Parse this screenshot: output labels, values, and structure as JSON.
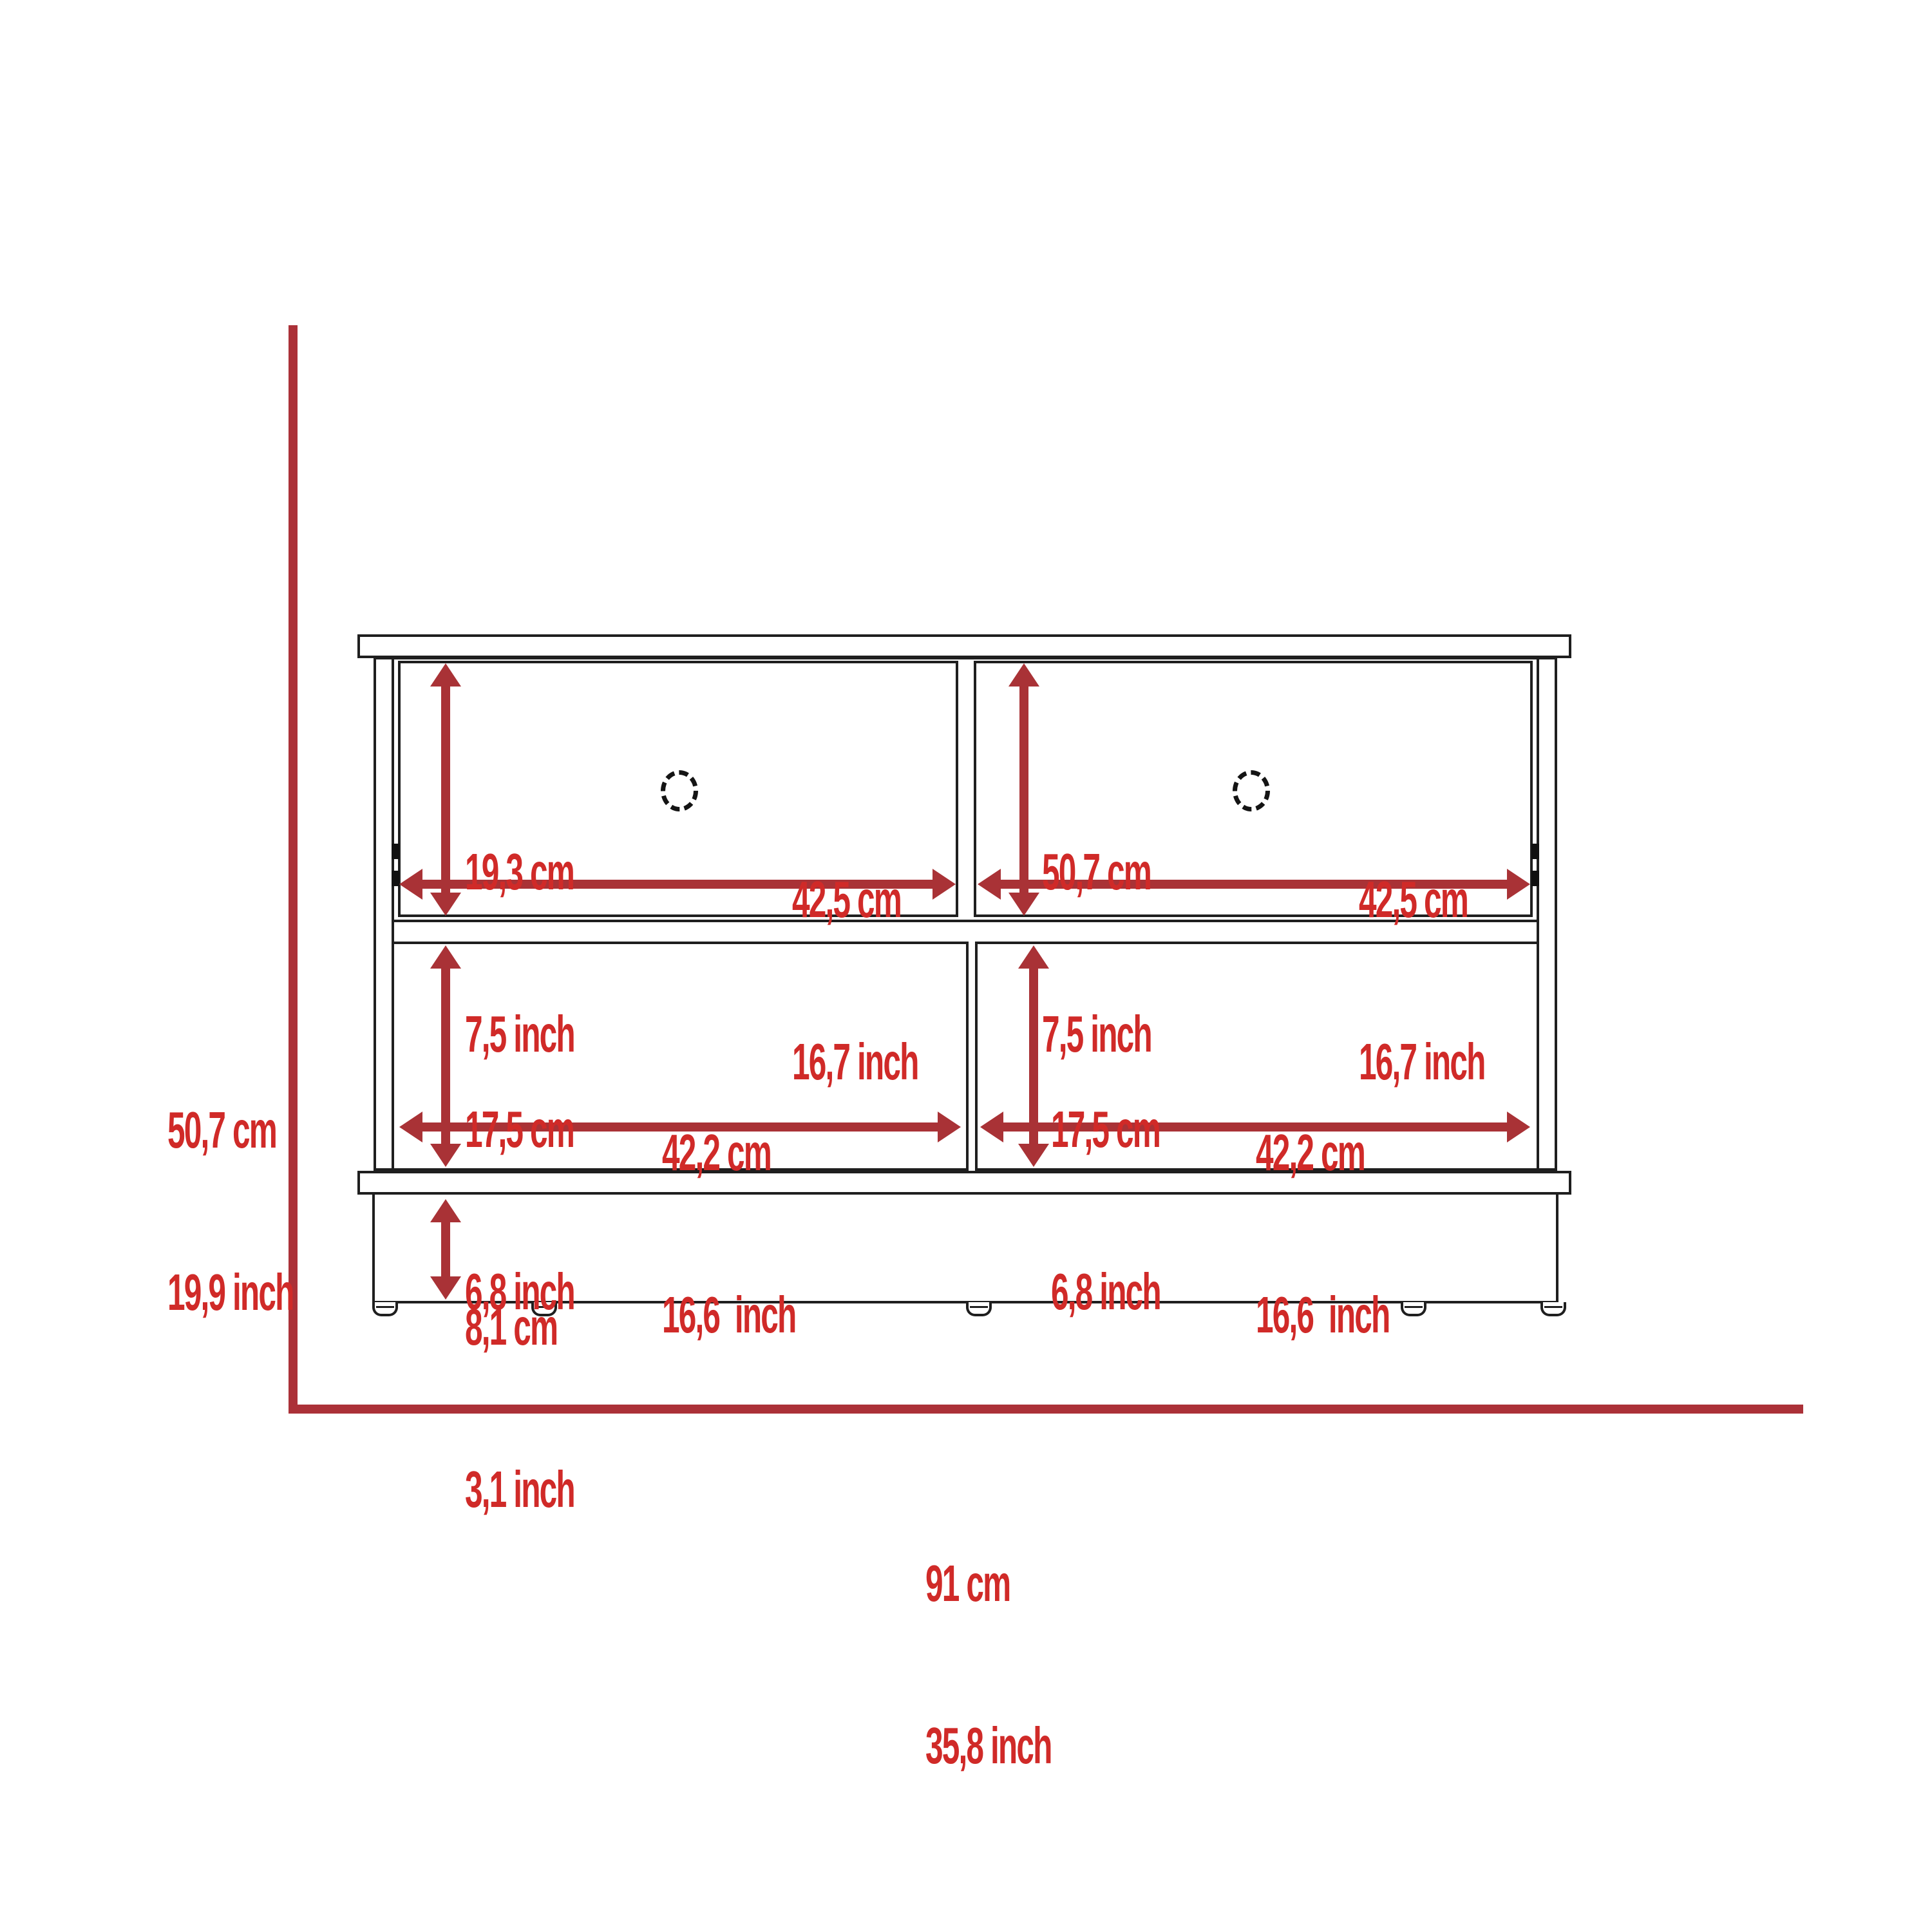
{
  "diagram": {
    "title": "storage-bench-dimension-drawing",
    "colors": {
      "background": "#ffffff",
      "outline": "#1f1f1f",
      "dimension_line": "#ab3138",
      "dimension_arrow": "#a93236",
      "label_text": "#d02a28"
    },
    "labels": {
      "overall_height": {
        "cm": "50,7 cm",
        "inch": "19,9 inch"
      },
      "overall_width": {
        "cm": "91 cm",
        "inch": "35,8 inch"
      },
      "top_left_drawer_height": {
        "cm": "19,3 cm",
        "inch": "7,5 inch"
      },
      "top_left_drawer_width": {
        "cm": "42,5 cm",
        "inch": "16,7 inch"
      },
      "top_right_drawer_height": {
        "cm": "50,7 cm",
        "inch": "7,5 inch"
      },
      "top_right_drawer_width": {
        "cm": "42,5 cm",
        "inch": "16,7 inch"
      },
      "bottom_left_shelf_height": {
        "cm": "17,5 cm",
        "inch": "6,8 inch"
      },
      "bottom_left_shelf_width": {
        "cm": "42,2 cm",
        "inch": "16,6  inch"
      },
      "bottom_right_shelf_height": {
        "cm": "17,5 cm",
        "inch": "6,8 inch"
      },
      "bottom_right_shelf_width": {
        "cm": "42,2 cm",
        "inch": "16,6  inch"
      },
      "base_height": {
        "cm": "8,1 cm",
        "inch": "3,1 inch"
      }
    }
  }
}
